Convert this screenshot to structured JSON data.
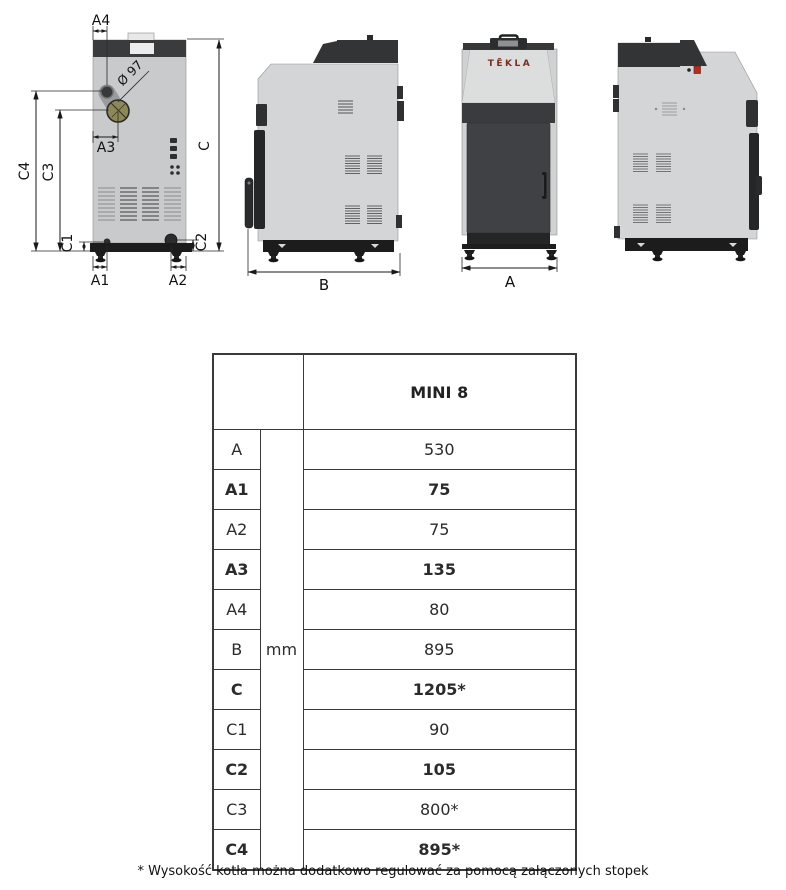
{
  "drawing": {
    "labels": {
      "a4": "A4",
      "diameter": "Ø 97",
      "a3": "A3",
      "c": "C",
      "c4": "C4",
      "c3": "C3",
      "c1": "C1",
      "c2": "C2",
      "a1": "A1",
      "a2": "A2",
      "b": "B",
      "a": "A"
    },
    "logo": "TĒKLA"
  },
  "table": {
    "model_header": "MINI 8",
    "unit": "mm",
    "rows": [
      {
        "label": "A",
        "value": "530",
        "bold": false
      },
      {
        "label": "A1",
        "value": "75",
        "bold": true
      },
      {
        "label": "A2",
        "value": "75",
        "bold": false
      },
      {
        "label": "A3",
        "value": "135",
        "bold": true
      },
      {
        "label": "A4",
        "value": "80",
        "bold": false
      },
      {
        "label": "B",
        "value": "895",
        "bold": false
      },
      {
        "label": "C",
        "value": "1205*",
        "bold": true
      },
      {
        "label": "C1",
        "value": "90",
        "bold": false
      },
      {
        "label": "C2",
        "value": "105",
        "bold": true
      },
      {
        "label": "C3",
        "value": "800*",
        "bold": false
      },
      {
        "label": "C4",
        "value": "895*",
        "bold": true
      }
    ]
  },
  "footnote": "* Wysokość kotła można dodatkowo regulować za pomocą załączonych stopek"
}
